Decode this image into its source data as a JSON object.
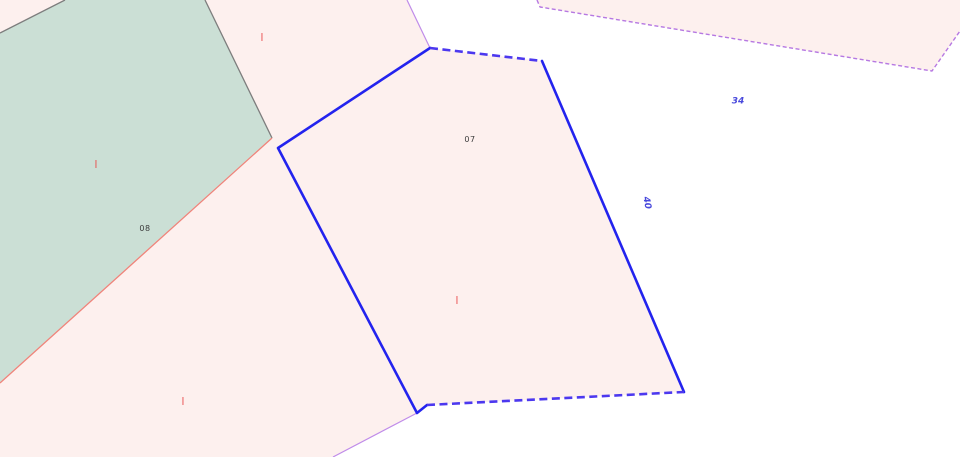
{
  "colors": {
    "pink_fill": "#fdf0ee",
    "green_fill": "#cbdfd5",
    "gray_line": "#7d7d7d",
    "salmon_line": "#f0837a",
    "blue_line": "#2323ee",
    "blue_dash": "#4c38ef",
    "violet_line": "#c08ce9",
    "violet_dash": "#b678e2",
    "label_dark": "#3c3c3c",
    "label_blue": "#4848dc",
    "mark_red": "#e94848"
  },
  "parcels": {
    "green": {
      "label": "08"
    },
    "selected": {
      "label": "07"
    }
  },
  "road_labels": {
    "right": "34",
    "edge": "40"
  },
  "icons": {
    "red_mark": "|"
  }
}
